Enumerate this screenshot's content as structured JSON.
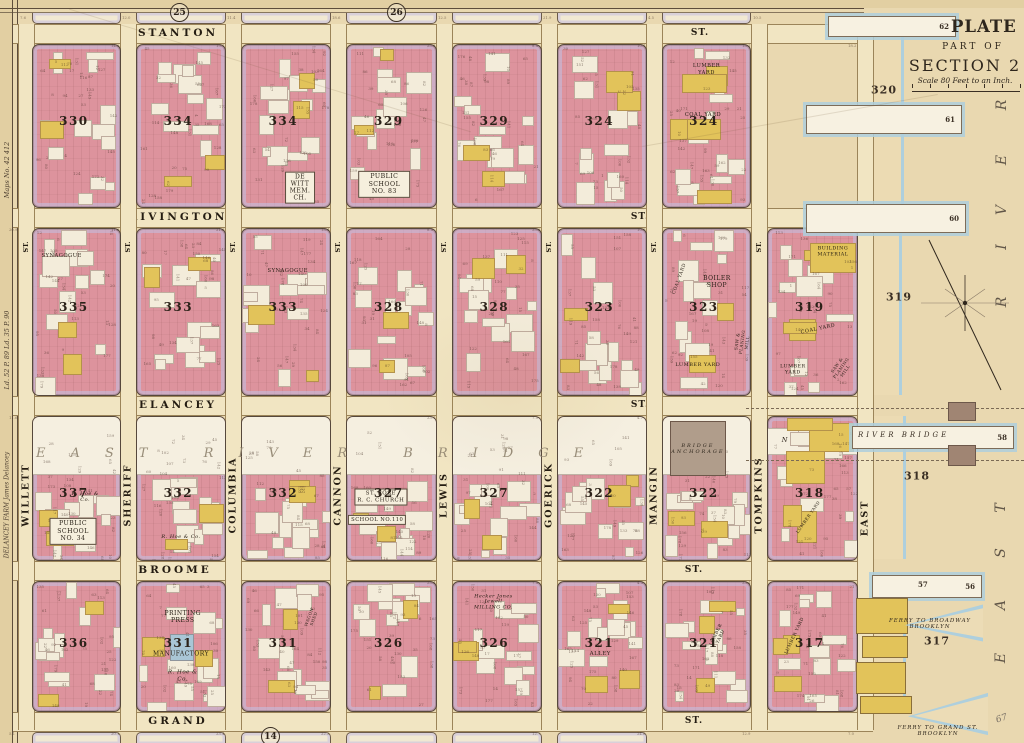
{
  "map": {
    "plate": "PLATE 15.",
    "part_of": "PART OF",
    "section": "SECTION 2",
    "scale_note": "Scale 80 Feet to an Inch.",
    "margin_circles": {
      "top_left": "25",
      "top_mid": "26",
      "bottom": "14"
    },
    "margin_notes": {
      "maps_no": "Maps No. 42 412",
      "liber": "Ld. 52 P. 89   Ld. 35 P. 90",
      "farm": "DELANCEY FARM   James Delancey",
      "pencil": "67"
    },
    "streets": {
      "st_abbrev": "ST.",
      "horizontal": [
        "STANTON",
        "RIVINGTON",
        "DELANCEY",
        "BROOME",
        "GRAND"
      ],
      "vertical": [
        "WILLETT",
        "SHERIFF",
        "COLUMBIA",
        "CANNON",
        "LEWIS",
        "GOERICK",
        "MANGIN",
        "TOMPKINS",
        "EAST"
      ]
    },
    "bridge": {
      "span_label": "EAST RIVER BRIDGE",
      "anchorage": "BRIDGE\nANCHORAGE",
      "new_east": "NEW EAST",
      "river_bridge": "RIVER BRIDGE"
    },
    "river": {
      "east_vertical": "EAST",
      "river_vertical": "RIVER",
      "piers": [
        "62",
        "61",
        "60",
        "58",
        "57",
        "56"
      ],
      "water_lot_numbers": [
        "320",
        "319",
        "318",
        "317"
      ],
      "ferry_labels": [
        "FERRY TO BROADWAY\nBROOKLYN",
        "FERRY TO GRAND ST.\nBROOKLYN"
      ]
    },
    "blocks": [
      {
        "number": "330",
        "col": 0,
        "row": 0
      },
      {
        "number": "334",
        "col": 1,
        "row": 0
      },
      {
        "number": "334",
        "col": 2,
        "row": 0,
        "labels": [
          {
            "t": "DE WITT\nMEM. CH.",
            "x": 0.66,
            "y": 0.88,
            "s": 6,
            "bg": true
          }
        ]
      },
      {
        "number": "329",
        "col": 3,
        "row": 0,
        "labels": [
          {
            "t": "PUBLIC SCHOOL\nNO. 83",
            "x": 0.42,
            "y": 0.86,
            "s": 6.2,
            "bg": true
          }
        ]
      },
      {
        "number": "329",
        "col": 4,
        "row": 0
      },
      {
        "number": "324",
        "col": 5,
        "row": 0
      },
      {
        "number": "324",
        "col": 6,
        "row": 0,
        "yellow": "high",
        "labels": [
          {
            "t": "LUMBER YARD",
            "x": 0.5,
            "y": 0.15,
            "s": 5.2
          },
          {
            "t": "COAL YARD",
            "x": 0.46,
            "y": 0.43,
            "s": 5.2
          }
        ]
      },
      {
        "number": "335",
        "col": 0,
        "row": 1,
        "labels": [
          {
            "t": "SYNAGOGUE",
            "x": 0.33,
            "y": 0.16,
            "s": 5.2
          }
        ]
      },
      {
        "number": "333",
        "col": 1,
        "row": 1
      },
      {
        "number": "333",
        "col": 2,
        "row": 1,
        "labels": [
          {
            "t": "SYNAGOGUE",
            "x": 0.52,
            "y": 0.25,
            "s": 5.2
          }
        ]
      },
      {
        "number": "328",
        "col": 3,
        "row": 1
      },
      {
        "number": "328",
        "col": 4,
        "row": 1
      },
      {
        "number": "323",
        "col": 5,
        "row": 1
      },
      {
        "number": "323",
        "col": 6,
        "row": 1,
        "labels": [
          {
            "t": "COAL YARD",
            "x": 0.2,
            "y": 0.3,
            "s": 4.6,
            "r": -70
          },
          {
            "t": "BOILER\nSHOP",
            "x": 0.62,
            "y": 0.32,
            "s": 6
          },
          {
            "t": "LUMBER YARD",
            "x": 0.4,
            "y": 0.82,
            "s": 5
          },
          {
            "t": "SAW & PLANING MILL",
            "x": 0.91,
            "y": 0.68,
            "s": 4.2,
            "r": -82
          }
        ]
      },
      {
        "number": "319",
        "col": 7,
        "row": 1,
        "yellow": "high",
        "labels": [
          {
            "t": "BUILDING\nMATERIAL",
            "x": 0.73,
            "y": 0.14,
            "s": 4.8
          },
          {
            "t": "COAL YARD",
            "x": 0.56,
            "y": 0.6,
            "s": 5,
            "r": -12
          },
          {
            "t": "LUMBER\nYARD",
            "x": 0.28,
            "y": 0.85,
            "s": 4.8
          },
          {
            "t": "SAW & PLANING MILL",
            "x": 0.82,
            "y": 0.84,
            "s": 4.2,
            "r": -55
          }
        ]
      },
      {
        "number": "337",
        "col": 0,
        "row": 2,
        "white_top": 0.4,
        "labels": [
          {
            "t": "R. Hoe & Co.",
            "x": 0.6,
            "y": 0.56,
            "s": 5,
            "i": true
          },
          {
            "t": "PUBLIC SCHOOL\nNO. 34",
            "x": 0.46,
            "y": 0.8,
            "s": 6.2,
            "bg": true
          }
        ]
      },
      {
        "number": "332",
        "col": 1,
        "row": 2,
        "white_top": 0.4,
        "labels": [
          {
            "t": "R. Hoe & Co.",
            "x": 0.5,
            "y": 0.84,
            "s": 5,
            "i": true
          }
        ]
      },
      {
        "number": "332",
        "col": 2,
        "row": 2,
        "white_top": 0.4
      },
      {
        "number": "327",
        "col": 3,
        "row": 2,
        "white_top": 0.4,
        "labels": [
          {
            "t": "ST. ROSE\nR. C. CHURCH",
            "x": 0.38,
            "y": 0.56,
            "s": 5.4,
            "bg": true
          },
          {
            "t": "SCHOOL NO.110",
            "x": 0.34,
            "y": 0.72,
            "s": 5.2,
            "bg": true
          }
        ]
      },
      {
        "number": "327",
        "col": 4,
        "row": 2,
        "white_top": 0.4
      },
      {
        "number": "322",
        "col": 5,
        "row": 2,
        "white_top": 0.4
      },
      {
        "number": "322",
        "col": 6,
        "row": 2,
        "white_top": 0.4,
        "anchorage": true
      },
      {
        "number": "318",
        "col": 7,
        "row": 2,
        "new_east": true,
        "yellow": "high",
        "labels": [
          {
            "t": "LUMBER YARD",
            "x": 0.45,
            "y": 0.7,
            "s": 4.2,
            "r": -55
          }
        ]
      },
      {
        "number": "336",
        "col": 0,
        "row": 3
      },
      {
        "number": "331",
        "col": 1,
        "row": 3,
        "blue": true,
        "labels": [
          {
            "t": "PRINTING PRESS",
            "x": 0.52,
            "y": 0.27,
            "s": 6
          },
          {
            "t": "MANUFACTORY",
            "x": 0.5,
            "y": 0.56,
            "s": 6
          },
          {
            "t": "R. Hoe & Co.",
            "x": 0.52,
            "y": 0.73,
            "s": 5.5,
            "i": true
          }
        ]
      },
      {
        "number": "331",
        "col": 2,
        "row": 3,
        "labels": [
          {
            "t": "WAGON SHED",
            "x": 0.8,
            "y": 0.28,
            "s": 4,
            "r": -70
          }
        ]
      },
      {
        "number": "326",
        "col": 3,
        "row": 3
      },
      {
        "number": "326",
        "col": 4,
        "row": 3,
        "labels": [
          {
            "t": "Hecker Jones Jewell\nMILLING CO.",
            "x": 0.46,
            "y": 0.16,
            "s": 4.8,
            "i": true
          }
        ]
      },
      {
        "number": "321",
        "col": 5,
        "row": 3,
        "yellow": "med",
        "labels": [
          {
            "t": "ALLEY",
            "x": 0.48,
            "y": 0.56,
            "s": 5.4
          }
        ]
      },
      {
        "number": "321",
        "col": 6,
        "row": 3,
        "yellow": "med",
        "labels": [
          {
            "t": "LUMBER YARD",
            "x": 0.64,
            "y": 0.42,
            "s": 4.4,
            "r": -65
          }
        ]
      },
      {
        "number": "317",
        "col": 7,
        "row": 3,
        "yellow": "med",
        "labels": [
          {
            "t": "LUMBER YARD",
            "x": 0.3,
            "y": 0.42,
            "s": 4.4,
            "r": -65
          }
        ]
      }
    ]
  }
}
